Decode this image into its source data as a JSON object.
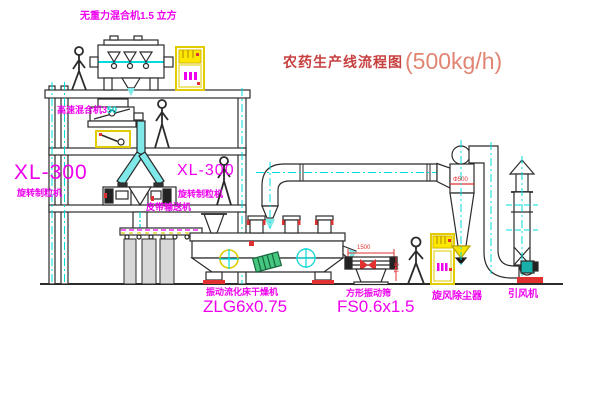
{
  "title": {
    "text": "农药生产线流程图",
    "capacity": "(500kg/h)"
  },
  "labels": {
    "gravity_mixer": "无重力混合机1.5 立方",
    "high_speed_mixer_prefix": "高速混合机3",
    "high_speed_mixer_suffix": "50",
    "xl_left_model": "XL-300",
    "xl_left_name": "旋转制粒机",
    "xl_right_model": "XL-300",
    "xl_right_name": "旋转制粒机",
    "belt_conveyor": "皮带输送机",
    "dryer_name": "振动流化床干燥机",
    "dryer_model": "ZLG6x0.75",
    "screen_name": "方形振动筛",
    "screen_model": "FS0.6x1.5",
    "cyclone": "旋风除尘器",
    "fan": "引风机"
  },
  "dimensions": {
    "screen_length": "1500",
    "screen_height": "541",
    "cyclone_diameter": "Φ500"
  },
  "colors": {
    "label_magenta": "#ee00ee",
    "centerline_cyan": "#00dcdc",
    "accent_red": "#e03030",
    "cabinet_yellow": "#f2e400",
    "drawing_line": "#2b2b2b",
    "title_red": "#c84040",
    "capacity_red": "#e08572",
    "chute_cyan_fill": "#7fe8e8",
    "valve_green": "#45c77f"
  }
}
